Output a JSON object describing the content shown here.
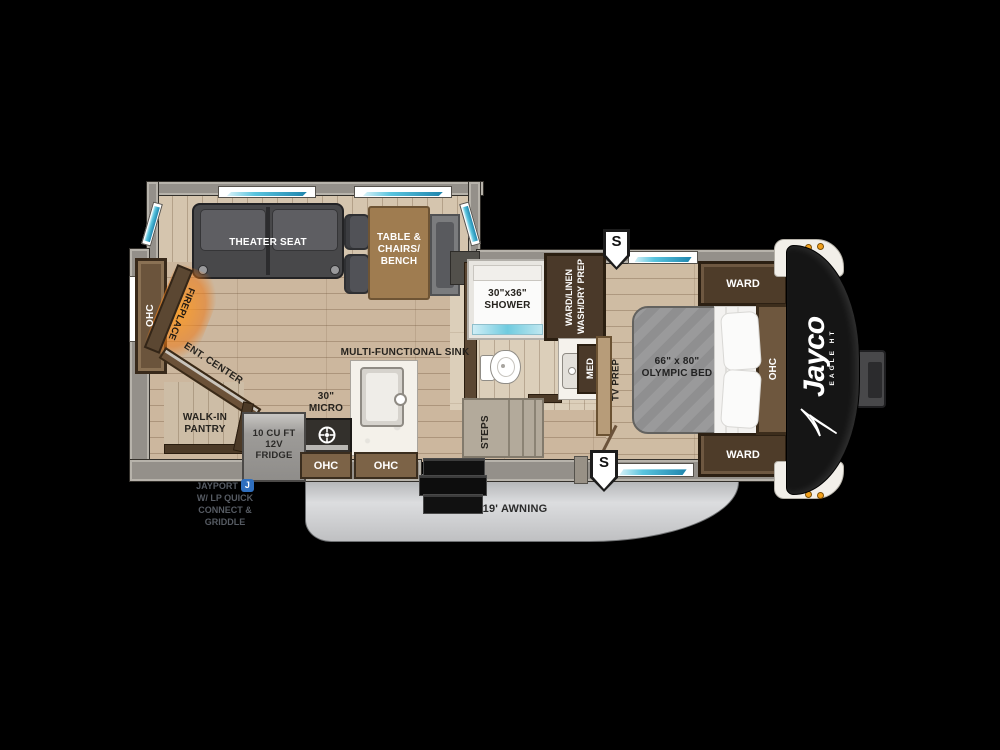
{
  "slideout": {
    "theater_seat": "THEATER SEAT",
    "dinette": {
      "l1": "TABLE &",
      "l2": "CHAIRS/",
      "l3": "BENCH"
    }
  },
  "living": {
    "ohc_rear": "OHC",
    "fireplace": "FIREPLACE",
    "ent_center": "ENT. CENTER",
    "pantry": {
      "l1": "WALK-IN",
      "l2": "PANTRY"
    }
  },
  "kitchen": {
    "sink_label": "MULTI-FUNCTIONAL SINK",
    "micro": {
      "l1": "30\"",
      "l2": "MICRO"
    },
    "fridge": {
      "l1": "10 CU FT",
      "l2": "12V",
      "l3": "FRIDGE"
    },
    "ohc_left": "OHC",
    "ohc_right": "OHC"
  },
  "bath": {
    "shower": {
      "l1": "30\"x36\"",
      "l2": "SHOWER"
    },
    "ward_linen": {
      "l1": "WARD/LINEN",
      "l2": "WASH/DRY PREP"
    },
    "med": "MED"
  },
  "bedroom": {
    "tv_prep": "TV PREP",
    "steps": "STEPS",
    "bed": {
      "l1": "66\" x 80\"",
      "l2": "OLYMPIC BED"
    },
    "ward_front_top": "WARD",
    "ward_front_bottom": "WARD",
    "ohc_front": "OHC"
  },
  "exterior": {
    "awning": "19' AWNING",
    "marker_top": "S",
    "marker_bottom": "S",
    "jayport": {
      "l1": "JAYPORT",
      "badge": "J",
      "l2": "W/ LP QUICK",
      "l3": "CONNECT &",
      "l4": "GRIDDLE"
    },
    "brand": "Jayco",
    "brand_sub": "EAGLE HT"
  },
  "colors": {
    "window_teal": "#59c4de",
    "accent_orange": "#e8940f",
    "badge_blue": "#2f6fbf",
    "floor_wood": "#ccb79e",
    "cabinet_wood": "#6e573e",
    "awning_gray": "#c9cacc"
  }
}
